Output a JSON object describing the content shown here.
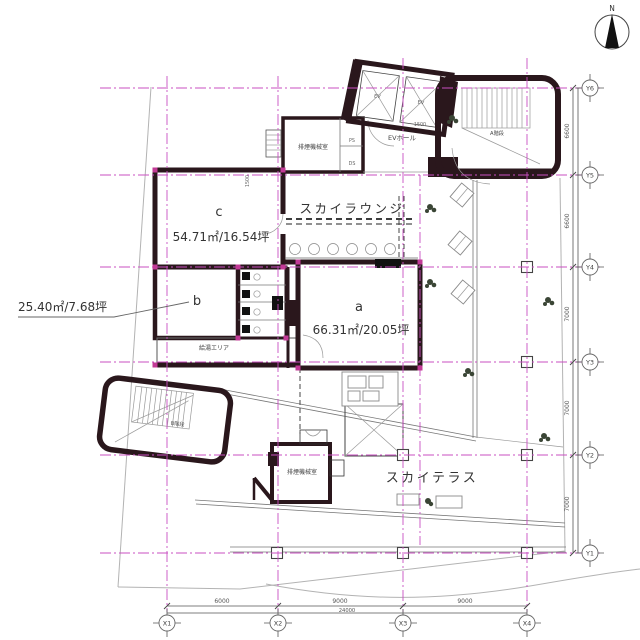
{
  "plan": {
    "north_label": "N",
    "rooms": {
      "a": {
        "letter": "a",
        "area": "66.31㎡/20.05坪"
      },
      "b": {
        "letter": "b",
        "area": "25.40㎡/7.68坪"
      },
      "c": {
        "letter": "c",
        "area": "54.71㎡/16.54坪"
      }
    },
    "areas": {
      "sky_lounge": "スカイラウンジ",
      "sky_terrace": "スカイテラス",
      "ev_hall": "EVホール",
      "elevator": "EV",
      "stair_a": "A階段",
      "stair_b": "B階段",
      "smoke_machine_room": "排煙機械室",
      "hot_water_area": "給湯エリア",
      "pipe_shaft": "PS",
      "duct_shaft": "DS"
    },
    "dimensions": {
      "x_dims": [
        "6000",
        "9000",
        "9000"
      ],
      "x_total": "24000",
      "y_dims": [
        "6600",
        "6600",
        "7000",
        "7000",
        "7000"
      ],
      "dim_1500": "1500"
    },
    "grid_bubbles": {
      "x": [
        "X1",
        "X2",
        "X3",
        "X4"
      ],
      "y": [
        "Y6",
        "Y5",
        "Y4",
        "Y3",
        "Y2",
        "Y1"
      ]
    },
    "colors": {
      "wall": "#2a171c",
      "grid_line": "#c94fc2",
      "room_a_fill": "#e5eef6",
      "room_bc_fill": "#ecf4e8",
      "column_accent": "#c23a96"
    }
  }
}
